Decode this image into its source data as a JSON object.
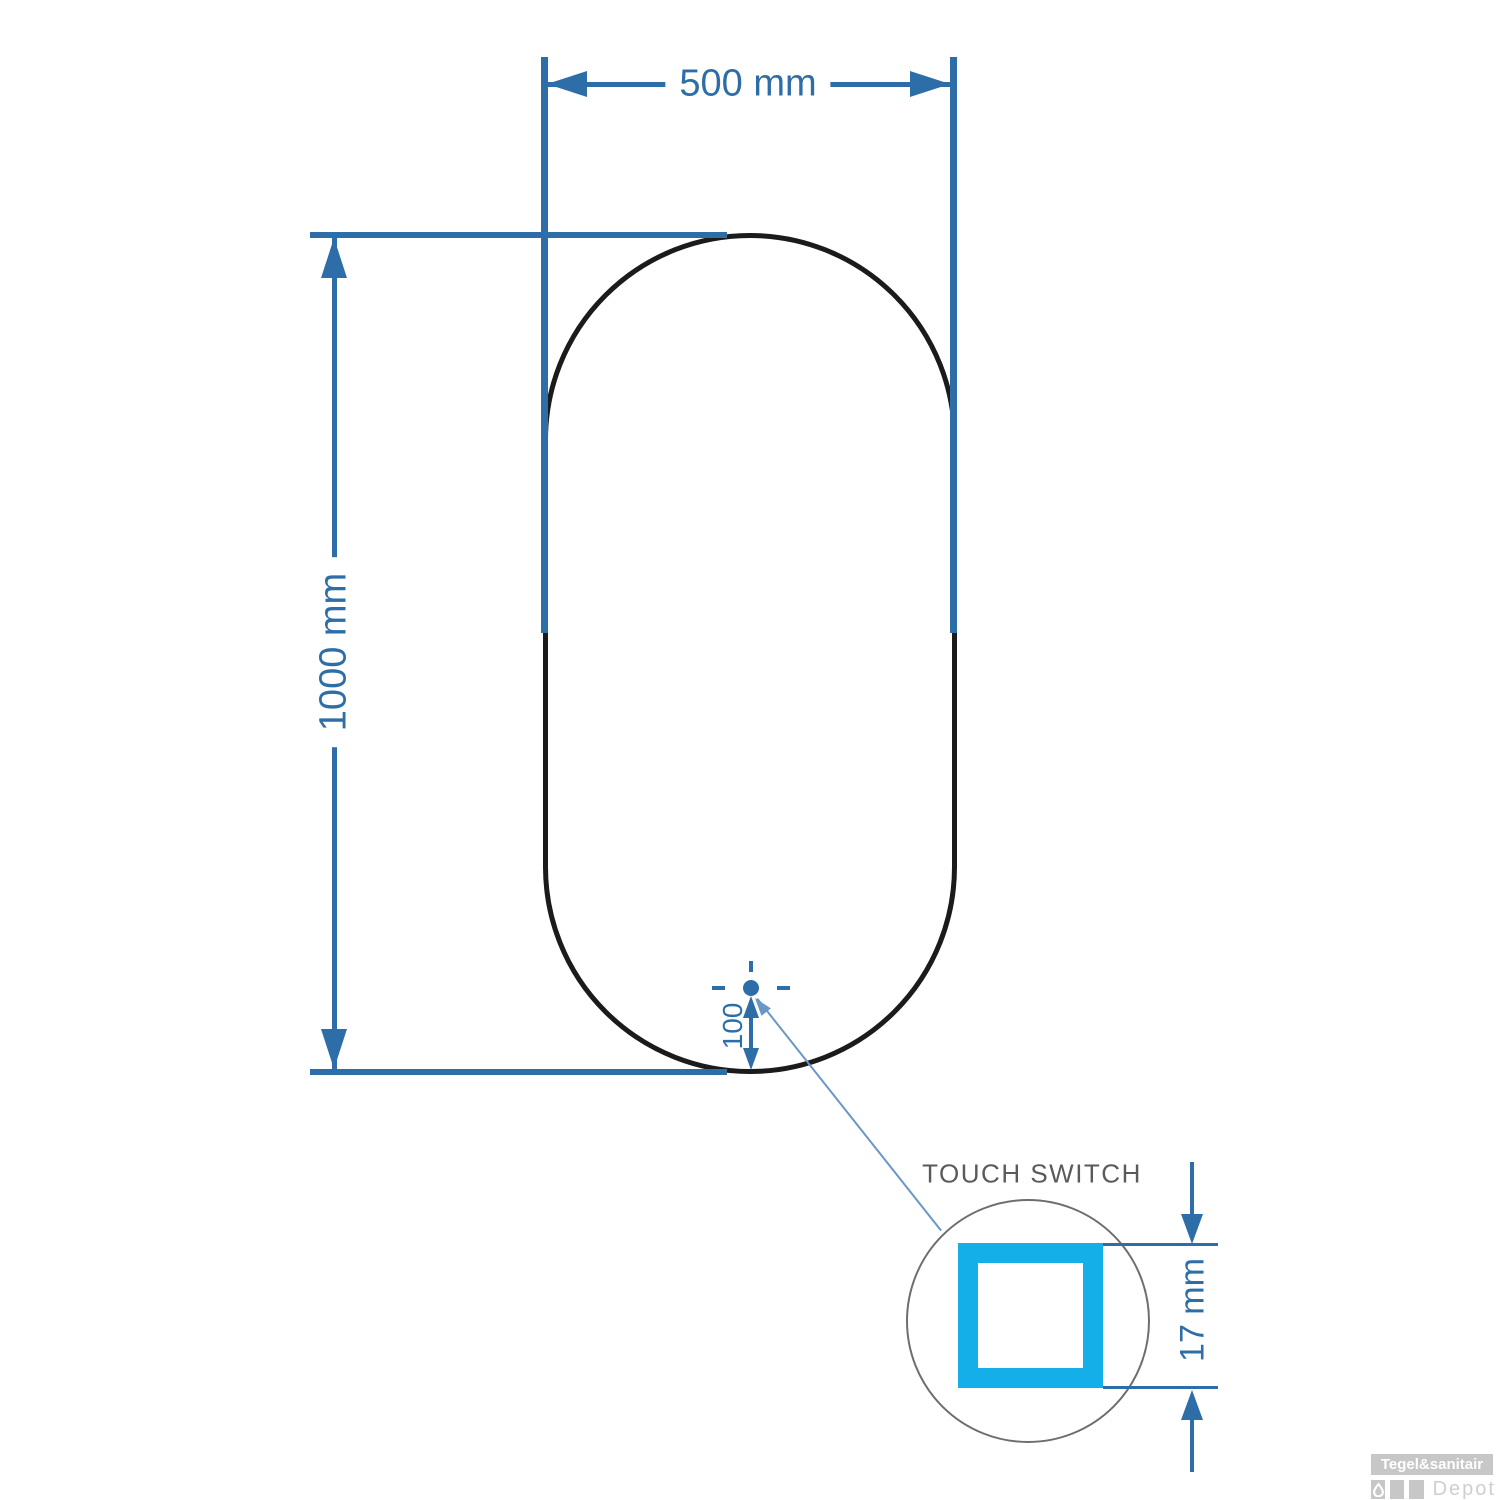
{
  "diagram": {
    "mirror": {
      "width_label": "500 mm",
      "height_label": "1000 mm",
      "switch_offset_label": "100"
    },
    "detail": {
      "label": "TOUCH SWITCH",
      "size_label": "17 mm"
    },
    "logo": {
      "line1": "Tegel&sanitair",
      "line2": "Depot"
    },
    "colors": {
      "dimension": "#2d6ea8",
      "leader": "#6b96c8",
      "accent_cyan": "#14aee9",
      "outline_black": "#1b1b1b",
      "detail_gray": "#6e6e6e",
      "label_gray": "#5a5a5a",
      "logo_gray": "#c7c7c7",
      "logo_light_gray": "#cfcfcf"
    }
  }
}
